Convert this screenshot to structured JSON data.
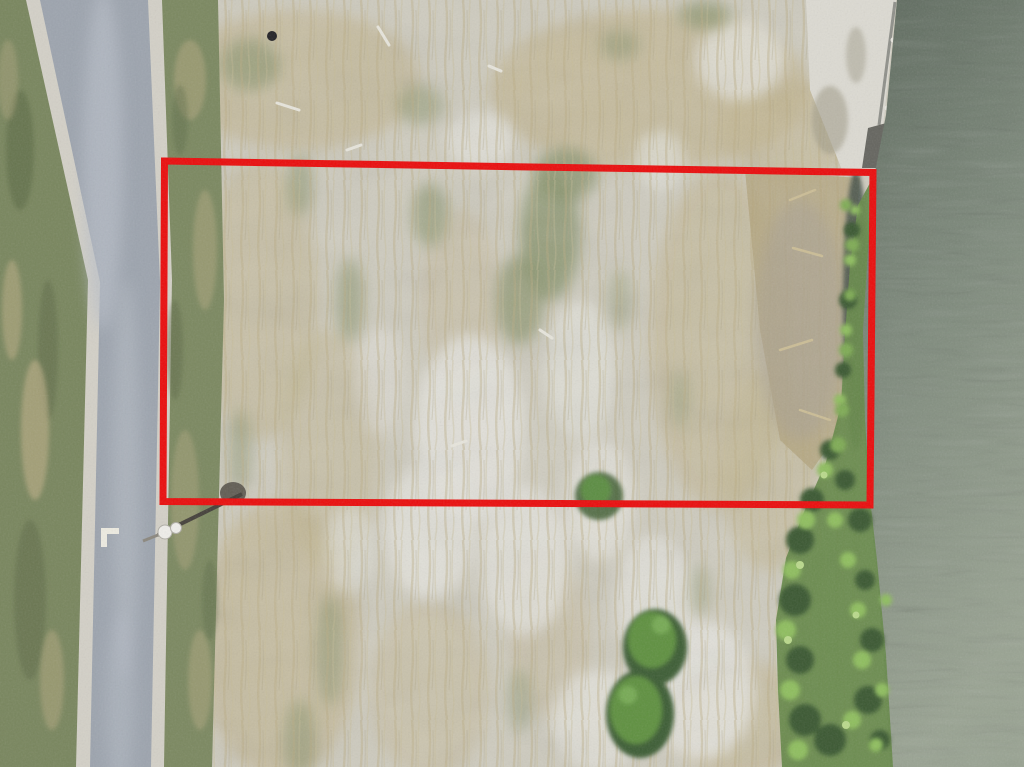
{
  "scene": {
    "kind": "aerial-drone-photo",
    "subject": "vacant land lot outlined with red property-boundary rectangle, road on left, pond on right"
  },
  "annotation": {
    "type": "property-boundary-rectangle",
    "color": "#ea0d0d"
  },
  "colors": {
    "boundary_red": "#ea0d0d",
    "field_base": "#cfccbf",
    "field_tan": "#bfb189",
    "field_sand": "#e3e2db",
    "field_moss": "#87926a",
    "grass_left": "#79865e",
    "grass_right": "#7b8860",
    "grass_dark": "#5b6946",
    "grass_tan": "#b5aa82",
    "road_shoulder": "#d3d0c7",
    "road_asphalt": "#9da4ae",
    "road_asphalt_light": "#b9bfc7",
    "road_marking": "#edebe1",
    "water_top": "#5e6a5e",
    "water_mid": "#7d897b",
    "water_bottom": "#9aa493",
    "shore_veg": "#67894b",
    "shore_veg_dark": "#3b5933",
    "shore_veg_bright": "#8fbe5e",
    "shore_veg_light": "#bad98c",
    "reeds_tan": "#b2a37c",
    "brush_gray": "#a7a095",
    "dark_water_edge": "#45514a",
    "sand_bank": "#dcdad2",
    "bulkhead": "#5e5f58",
    "bulkhead_light": "#8f908a",
    "pole": "#44403a",
    "lamp": "#efeeea",
    "bush_green": "#5e9041",
    "bush_dark": "#3e5d34",
    "bush_light": "#77aa55",
    "stick": "#e7e5dc",
    "debris": "#232327"
  }
}
